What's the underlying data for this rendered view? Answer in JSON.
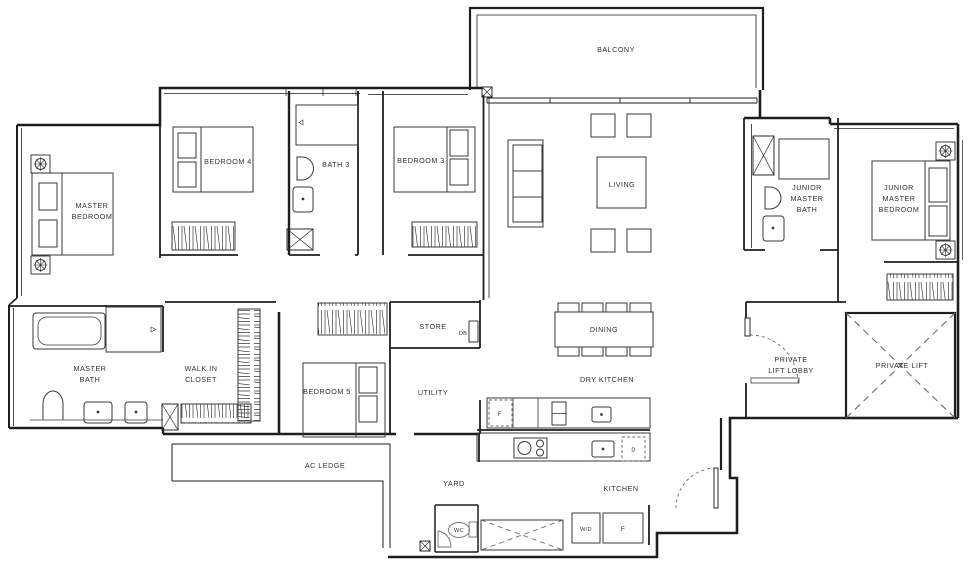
{
  "labels": {
    "balcony": [
      "BALCONY"
    ],
    "master_bedroom": [
      "MASTER",
      "BEDROOM"
    ],
    "bedroom_4": [
      "BEDROOM 4"
    ],
    "bath_3": [
      "BATH 3"
    ],
    "bedroom_3": [
      "BEDROOM 3"
    ],
    "living": [
      "LIVING"
    ],
    "junior_master_bath": [
      "JUNIOR",
      "MASTER",
      "BATH"
    ],
    "junior_master_bedroom": [
      "JUNIOR",
      "MASTER",
      "BEDROOM"
    ],
    "master_bath": [
      "MASTER",
      "BATH"
    ],
    "walk_in_closet": [
      "WALK IN",
      "CLOSET"
    ],
    "bedroom_5": [
      "BEDROOM 5"
    ],
    "store": [
      "STORE"
    ],
    "distribution_board": [
      "DB"
    ],
    "utility": [
      "UTILITY"
    ],
    "dining": [
      "DINING"
    ],
    "dry_kitchen": [
      "DRY KITCHEN"
    ],
    "private_lift_lobby": [
      "PRIVATE",
      "LIFT LOBBY"
    ],
    "private_lift": [
      "PRIVATE LIFT"
    ],
    "ac_ledge": [
      "AC LEDGE"
    ],
    "yard": [
      "YARD"
    ],
    "kitchen": [
      "KITCHEN"
    ],
    "wc": [
      "WC"
    ],
    "washer_dryer": [
      "W/D"
    ],
    "fridge_dry_kitchen": [
      "F"
    ],
    "fridge_kitchen": [
      "F"
    ],
    "dishwasher": [
      "D"
    ]
  },
  "colors": {
    "wall": "#1e1e1e",
    "furniture": "#3a3a3a",
    "text": "#2f2f2f",
    "dashed": "#6b6b6b",
    "background": "#ffffff"
  }
}
